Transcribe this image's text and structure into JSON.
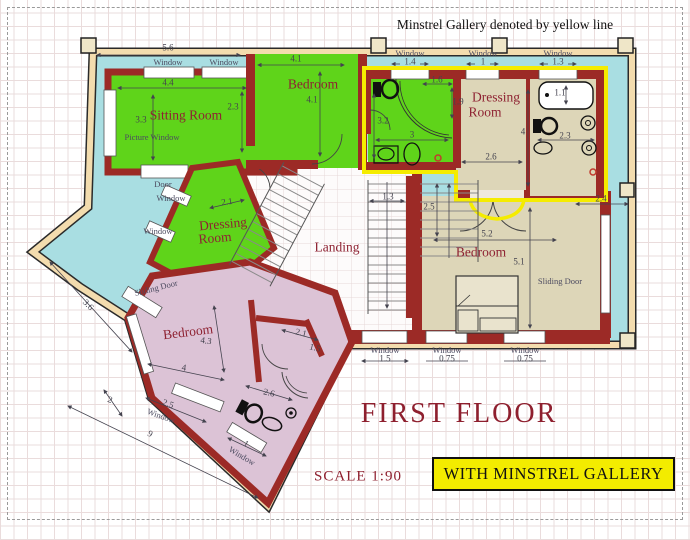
{
  "page": {
    "note": "Minstrel Gallery denoted by yellow line",
    "title": "FIRST FLOOR",
    "scale": "SCALE  1:90",
    "banner": "WITH MINSTREL GALLERY"
  },
  "colors": {
    "wall_red": "#9c2a26",
    "room_green": "#5fd41a",
    "room_pink": "#dcc3d6",
    "room_tan": "#ddd6b8",
    "balcony_cyan": "#a9dee2",
    "gallery_yellow": "#f5ec00",
    "outer_band_tan": "#f3dcae",
    "title_red": "#8e1f2e",
    "banner_yellow": "#f3ec00"
  },
  "labels": [
    {
      "t": "Sitting Room",
      "x": 186,
      "y": 115,
      "c": "room",
      "n": "sitting-room-label"
    },
    {
      "t": "Bedroom",
      "x": 313,
      "y": 84,
      "c": "room",
      "n": "bedroom-top-label"
    },
    {
      "t": "Dressing",
      "x": 496,
      "y": 97,
      "c": "room",
      "n": "dressing-room-tr-label-line1"
    },
    {
      "t": "Room",
      "x": 485,
      "y": 112,
      "c": "room",
      "n": "dressing-room-tr-label-line2"
    },
    {
      "t": "Dressing",
      "x": 223,
      "y": 224,
      "c": "room",
      "r": -5,
      "n": "dressing-room-mid-label-line1"
    },
    {
      "t": "Room",
      "x": 215,
      "y": 238,
      "c": "room",
      "r": -5,
      "n": "dressing-room-mid-label-line2"
    },
    {
      "t": "Landing",
      "x": 337,
      "y": 247,
      "c": "room",
      "n": "landing-label"
    },
    {
      "t": "Bedroom",
      "x": 481,
      "y": 252,
      "c": "room",
      "n": "bedroom-right-label"
    },
    {
      "t": "Bedroom",
      "x": 188,
      "y": 332,
      "c": "room",
      "r": -7,
      "n": "bedroom-pink-label"
    },
    {
      "t": "Window",
      "x": 168,
      "y": 62,
      "c": "tag"
    },
    {
      "t": "Window",
      "x": 224,
      "y": 62,
      "c": "tag"
    },
    {
      "t": "Picture Window",
      "x": 152,
      "y": 137,
      "c": "tag"
    },
    {
      "t": "Door",
      "x": 163,
      "y": 184,
      "c": "tag"
    },
    {
      "t": "Window",
      "x": 171,
      "y": 198,
      "c": "tag"
    },
    {
      "t": "Window",
      "x": 158,
      "y": 231,
      "c": "tag"
    },
    {
      "t": "Sliding Door",
      "x": 156,
      "y": 288,
      "c": "tag",
      "r": -14
    },
    {
      "t": "Window",
      "x": 410,
      "y": 53,
      "c": "tag"
    },
    {
      "t": "Window",
      "x": 483,
      "y": 53,
      "c": "tag"
    },
    {
      "t": "Window",
      "x": 558,
      "y": 53,
      "c": "tag"
    },
    {
      "t": "Sliding Door",
      "x": 560,
      "y": 281,
      "c": "tag"
    },
    {
      "t": "Window",
      "x": 385,
      "y": 350,
      "c": "tag"
    },
    {
      "t": "Window",
      "x": 447,
      "y": 350,
      "c": "tag"
    },
    {
      "t": "Window",
      "x": 525,
      "y": 350,
      "c": "tag"
    },
    {
      "t": "Window",
      "x": 161,
      "y": 416,
      "c": "tag",
      "r": 20
    },
    {
      "t": "Window",
      "x": 242,
      "y": 456,
      "c": "tag",
      "r": 31
    },
    {
      "t": "5.6",
      "x": 168,
      "y": 48,
      "c": "dim"
    },
    {
      "t": "4.4",
      "x": 168,
      "y": 83,
      "c": "dim"
    },
    {
      "t": "3.3",
      "x": 141,
      "y": 120,
      "c": "dim"
    },
    {
      "t": "2.3",
      "x": 233,
      "y": 107,
      "c": "dim"
    },
    {
      "t": "4.1",
      "x": 296,
      "y": 59,
      "c": "dim"
    },
    {
      "t": "4.1",
      "x": 312,
      "y": 100,
      "c": "dim"
    },
    {
      "t": "1.4",
      "x": 410,
      "y": 62,
      "c": "dim"
    },
    {
      "t": "1",
      "x": 483,
      "y": 62,
      "c": "dim"
    },
    {
      "t": "1.3",
      "x": 558,
      "y": 62,
      "c": "dim"
    },
    {
      "t": "1.6",
      "x": 437,
      "y": 80,
      "c": "dim"
    },
    {
      "t": "1.9",
      "x": 458,
      "y": 102,
      "c": "dim"
    },
    {
      "t": "3.2",
      "x": 383,
      "y": 121,
      "c": "dim"
    },
    {
      "t": "3",
      "x": 412,
      "y": 135,
      "c": "dim"
    },
    {
      "t": "2.6",
      "x": 491,
      "y": 157,
      "c": "dim"
    },
    {
      "t": "4",
      "x": 523,
      "y": 132,
      "c": "dim"
    },
    {
      "t": "1.1",
      "x": 560,
      "y": 93,
      "c": "dim"
    },
    {
      "t": "2.3",
      "x": 565,
      "y": 136,
      "c": "dim"
    },
    {
      "t": "2.4",
      "x": 601,
      "y": 199,
      "c": "dim"
    },
    {
      "t": "1.3",
      "x": 388,
      "y": 197,
      "c": "dim"
    },
    {
      "t": "2.5",
      "x": 429,
      "y": 207,
      "c": "dim"
    },
    {
      "t": "2.1",
      "x": 227,
      "y": 202,
      "c": "dim",
      "r": -8
    },
    {
      "t": "5.2",
      "x": 487,
      "y": 234,
      "c": "dim"
    },
    {
      "t": "5.1",
      "x": 519,
      "y": 262,
      "c": "dim"
    },
    {
      "t": "1.5",
      "x": 385,
      "y": 359,
      "c": "dim"
    },
    {
      "t": "0.75",
      "x": 447,
      "y": 359,
      "c": "dim"
    },
    {
      "t": "0.75",
      "x": 525,
      "y": 359,
      "c": "dim"
    },
    {
      "t": "2.1",
      "x": 301,
      "y": 333,
      "c": "dim",
      "r": 14
    },
    {
      "t": "1.5",
      "x": 315,
      "y": 348,
      "c": "dim",
      "r": 14
    },
    {
      "t": "2.6",
      "x": 269,
      "y": 393,
      "c": "dim",
      "r": 14
    },
    {
      "t": "4.3",
      "x": 206,
      "y": 341,
      "c": "dim",
      "r": 8
    },
    {
      "t": "4",
      "x": 184,
      "y": 368,
      "c": "dim",
      "r": 8
    },
    {
      "t": "3.6",
      "x": 88,
      "y": 305,
      "c": "dim",
      "r": 46
    },
    {
      "t": "2",
      "x": 110,
      "y": 400,
      "c": "dim",
      "r": 20
    },
    {
      "t": "9",
      "x": 150,
      "y": 434,
      "c": "dim",
      "r": 27
    },
    {
      "t": "2.5",
      "x": 168,
      "y": 404,
      "c": "dim",
      "r": 20
    },
    {
      "t": "1",
      "x": 246,
      "y": 444,
      "c": "dim",
      "r": 31
    }
  ]
}
